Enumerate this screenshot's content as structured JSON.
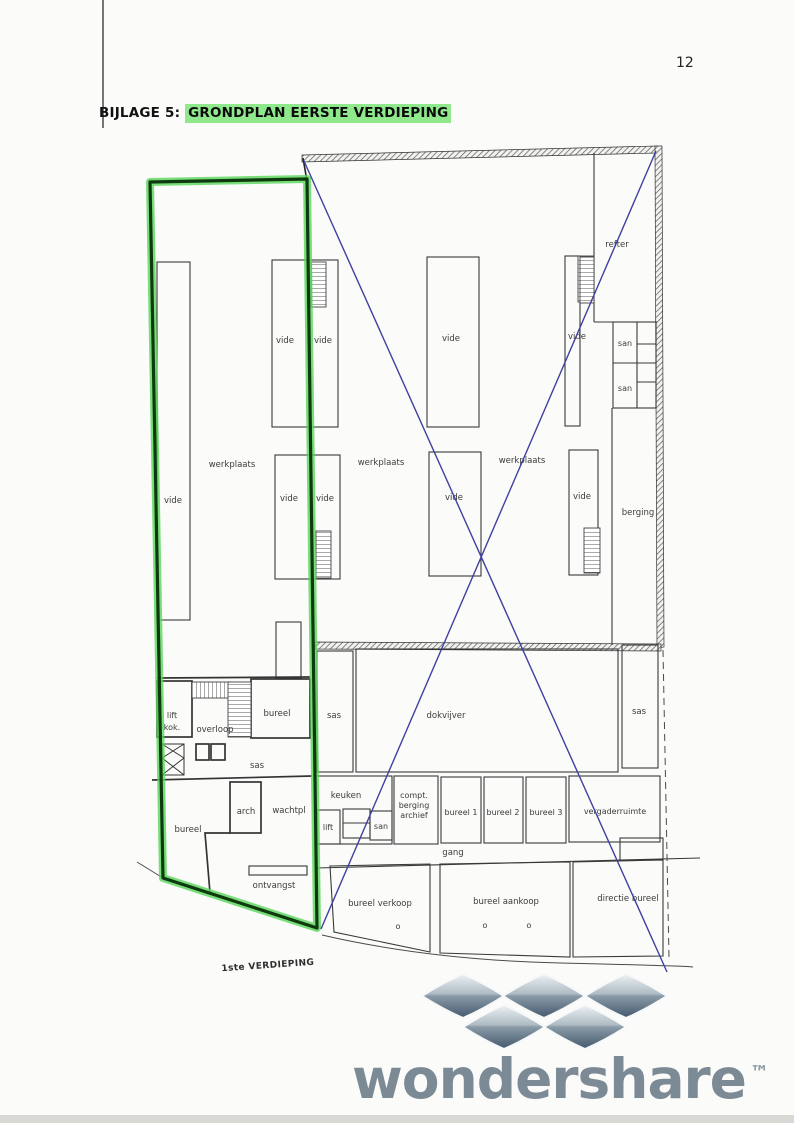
{
  "page": {
    "number": "12"
  },
  "header": {
    "title_prefix": "BIJLAGE 5:",
    "title_highlight": "GRONDPLAN EERSTE VERDIEPING"
  },
  "plan": {
    "caption": "1ste VERDIEPING",
    "labels": {
      "refter": "refter",
      "vide": "vide",
      "san": "san",
      "werkplaats": "werkplaats",
      "berging": "berging",
      "lift_shaft_line1": "lift",
      "lift_shaft_line2": "kok.",
      "overloop": "overloop",
      "bureel": "bureel",
      "sas": "sas",
      "dokvijver": "dokvijver",
      "keuken": "keuken",
      "compt_line1": "compt.",
      "compt_line2": "berging",
      "compt_line3": "archief",
      "bureel1": "bureel 1",
      "bureel2": "bureel 2",
      "bureel3": "bureel 3",
      "vergaderruimte": "vergaderruimte",
      "lift": "lift",
      "arch": "arch",
      "wachtpl": "wachtpl",
      "gang": "gang",
      "ontvangst": "ontvangst",
      "bureel_verkoop": "bureel verkoop",
      "bureel_aankoop": "bureel aankoop",
      "directie_bureel": "directie bureel",
      "door_marker": "o"
    }
  },
  "watermark": {
    "brand": "wondershare",
    "tm": "™"
  },
  "colors": {
    "title_highlight_green": "#8fe98c",
    "outline_green_bright": "#59d659",
    "outline_green_dark": "#0f3a0f",
    "annotation_blue": "#4040a0",
    "plan_line": "#3a3a3a",
    "watermark_slate": "#7b8a95"
  }
}
